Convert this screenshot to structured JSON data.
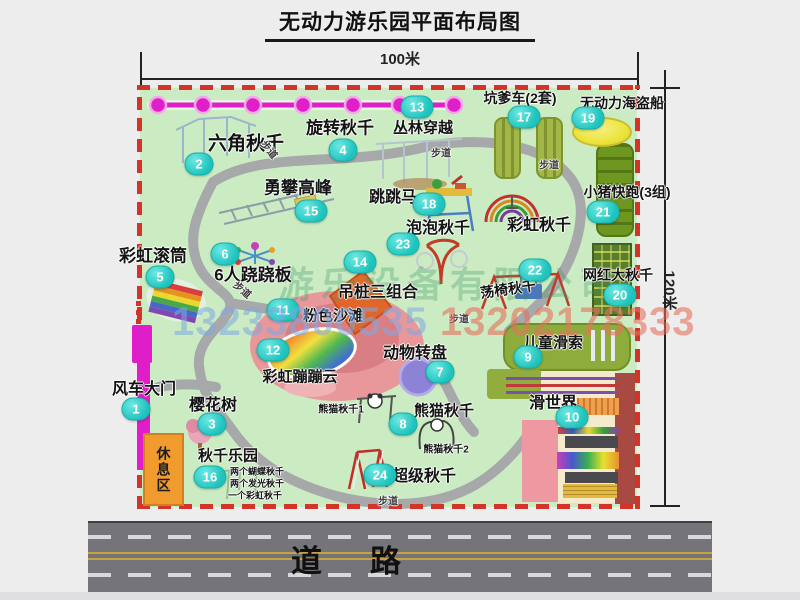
{
  "title": "无动力游乐园平面布局图",
  "dimensions": {
    "width": "100米",
    "height": "120米"
  },
  "road": {
    "label": "道路"
  },
  "rest_area": {
    "label": "休息区"
  },
  "watermark": {
    "company": "游乐设备有限公司",
    "phone1": "13233800535",
    "phone2": "13202178333"
  },
  "walkway_label": "步道",
  "attractions": [
    {
      "num": "1",
      "name": "风车大门",
      "bx": 136,
      "by": 409,
      "lx": 144,
      "ly": 387,
      "fs": 16
    },
    {
      "num": "2",
      "name": "六角秋千",
      "bx": 199,
      "by": 164,
      "lx": 246,
      "ly": 142,
      "fs": 19
    },
    {
      "num": "3",
      "name": "樱花树",
      "bx": 212,
      "by": 424,
      "lx": 213,
      "ly": 403,
      "fs": 16
    },
    {
      "num": "4",
      "name": "旋转秋千",
      "bx": 343,
      "by": 150,
      "lx": 340,
      "ly": 126,
      "fs": 17
    },
    {
      "num": "5",
      "name": "彩虹滚筒",
      "bx": 160,
      "by": 277,
      "lx": 153,
      "ly": 254,
      "fs": 17
    },
    {
      "num": "6",
      "name": "6人跷跷板",
      "bx": 225,
      "by": 254,
      "lx": 253,
      "ly": 273,
      "fs": 17
    },
    {
      "num": "7",
      "name": "动物转盘",
      "bx": 440,
      "by": 372,
      "lx": 415,
      "ly": 351,
      "fs": 16
    },
    {
      "num": "8",
      "name": "熊猫秋千",
      "bx": 403,
      "by": 424,
      "lx": 444,
      "ly": 410,
      "fs": 15
    },
    {
      "num": "9",
      "name": "儿童滑索",
      "bx": 528,
      "by": 357,
      "lx": 553,
      "ly": 342,
      "fs": 15
    },
    {
      "num": "10",
      "name": "滑世界",
      "bx": 572,
      "by": 417,
      "lx": 553,
      "ly": 401,
      "fs": 16
    },
    {
      "num": "11",
      "name": "粉色沙滩",
      "bx": 283,
      "by": 310,
      "lx": 333,
      "ly": 315,
      "fs": 15
    },
    {
      "num": "12",
      "name": "彩虹蹦蹦云",
      "bx": 273,
      "by": 350,
      "lx": 300,
      "ly": 376,
      "fs": 15
    },
    {
      "num": "13",
      "name": "丛林穿越",
      "bx": 417,
      "by": 107,
      "lx": 423,
      "ly": 127,
      "fs": 15
    },
    {
      "num": "14",
      "name": "吊桩三组合",
      "bx": 360,
      "by": 262,
      "lx": 378,
      "ly": 290,
      "fs": 16
    },
    {
      "num": "15",
      "name": "勇攀高峰",
      "bx": 311,
      "by": 211,
      "lx": 298,
      "ly": 186,
      "fs": 17
    },
    {
      "num": "16",
      "name": "秋千乐园",
      "bx": 210,
      "by": 477,
      "lx": 228,
      "ly": 455,
      "fs": 15
    },
    {
      "num": "17",
      "name": "坑爹车(2套)",
      "bx": 524,
      "by": 117,
      "lx": 520,
      "ly": 98,
      "fs": 14
    },
    {
      "num": "18",
      "name": "跳跳马",
      "bx": 429,
      "by": 204,
      "lx": 393,
      "ly": 195,
      "fs": 16
    },
    {
      "num": "19",
      "name": "无动力海盗船",
      "bx": 588,
      "by": 118,
      "lx": 622,
      "ly": 103,
      "fs": 14
    },
    {
      "num": "20",
      "name": "网红大秋千",
      "bx": 620,
      "by": 295,
      "lx": 618,
      "ly": 275,
      "fs": 14
    },
    {
      "num": "21",
      "name": "小猪快跑(3组)",
      "bx": 603,
      "by": 212,
      "lx": 627,
      "ly": 192,
      "fs": 14
    },
    {
      "num": "22",
      "name": "荡椅秋千",
      "bx": 535,
      "by": 270,
      "lx": 508,
      "ly": 289,
      "fs": 14,
      "lrot": -8
    },
    {
      "num": "23",
      "name": "泡泡秋千",
      "bx": 403,
      "by": 244,
      "lx": 438,
      "ly": 226,
      "fs": 16
    },
    {
      "num": "24",
      "name": "超级秋千",
      "bx": 380,
      "by": 475,
      "lx": 424,
      "ly": 474,
      "fs": 16
    }
  ],
  "extra_labels": [
    {
      "text": "彩虹秋千",
      "x": 539,
      "y": 223,
      "fs": 16
    },
    {
      "text": "熊猫秋千1",
      "x": 341,
      "y": 408,
      "fs": 10
    },
    {
      "text": "熊猫秋千2",
      "x": 446,
      "y": 448,
      "fs": 10
    },
    {
      "text": "两个蝴蝶秋千",
      "x": 257,
      "y": 471,
      "fs": 9
    },
    {
      "text": "两个发光秋千",
      "x": 257,
      "y": 483,
      "fs": 9
    },
    {
      "text": "一个彩虹秋千",
      "x": 255,
      "y": 495,
      "fs": 9
    }
  ],
  "walkways": [
    {
      "x": 270,
      "y": 149,
      "rot": 50
    },
    {
      "x": 441,
      "y": 152,
      "rot": 0
    },
    {
      "x": 549,
      "y": 164,
      "rot": 0
    },
    {
      "x": 243,
      "y": 289,
      "rot": 40
    },
    {
      "x": 459,
      "y": 318,
      "rot": 0
    },
    {
      "x": 388,
      "y": 500,
      "rot": 0
    }
  ]
}
